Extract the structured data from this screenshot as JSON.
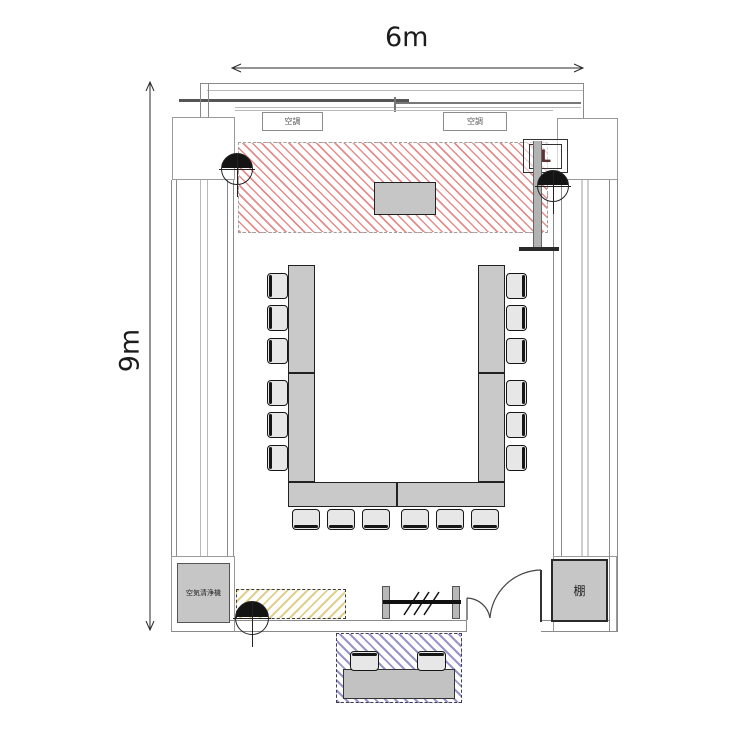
{
  "dimensions": {
    "width_label": "6m",
    "height_label": "9m"
  },
  "room": {
    "aircon_units": [
      {
        "label": "空調"
      },
      {
        "label": "空調"
      }
    ],
    "air_purifier_label": "空気清浄機",
    "shelf_label": "棚",
    "equipment_label": "L"
  },
  "zones": [
    {
      "name": "screen-projection-zone",
      "hatch": "red",
      "accent": "#d54646"
    },
    {
      "name": "floor-storage-zone",
      "hatch": "yellow",
      "accent": "#dbc776"
    },
    {
      "name": "waiting-bench-zone",
      "hatch": "blue",
      "accent": "#6868b4"
    }
  ],
  "colors": {
    "table_fill": "#c9c9c9",
    "wall_line": "#8a8a8a",
    "chair_fill": "#e7e7e7"
  },
  "furniture": {
    "tables": [
      {
        "x": 288,
        "y": 265,
        "w": 27,
        "h": 108
      },
      {
        "x": 288,
        "y": 373,
        "w": 27,
        "h": 109
      },
      {
        "x": 478,
        "y": 265,
        "w": 27,
        "h": 108
      },
      {
        "x": 478,
        "y": 373,
        "w": 27,
        "h": 109
      },
      {
        "x": 288,
        "y": 482,
        "w": 109,
        "h": 25
      },
      {
        "x": 397,
        "y": 482,
        "w": 108,
        "h": 25
      }
    ],
    "chairs": [
      {
        "x": 267,
        "y": 273,
        "w": 21,
        "h": 26,
        "dir": "w"
      },
      {
        "x": 267,
        "y": 305,
        "w": 21,
        "h": 26,
        "dir": "w"
      },
      {
        "x": 267,
        "y": 338,
        "w": 21,
        "h": 26,
        "dir": "w"
      },
      {
        "x": 267,
        "y": 380,
        "w": 21,
        "h": 26,
        "dir": "w"
      },
      {
        "x": 267,
        "y": 412,
        "w": 21,
        "h": 26,
        "dir": "w"
      },
      {
        "x": 267,
        "y": 445,
        "w": 21,
        "h": 26,
        "dir": "w"
      },
      {
        "x": 506,
        "y": 273,
        "w": 21,
        "h": 26,
        "dir": "e"
      },
      {
        "x": 506,
        "y": 305,
        "w": 21,
        "h": 26,
        "dir": "e"
      },
      {
        "x": 506,
        "y": 338,
        "w": 21,
        "h": 26,
        "dir": "e"
      },
      {
        "x": 506,
        "y": 380,
        "w": 21,
        "h": 26,
        "dir": "e"
      },
      {
        "x": 506,
        "y": 412,
        "w": 21,
        "h": 26,
        "dir": "e"
      },
      {
        "x": 506,
        "y": 445,
        "w": 21,
        "h": 26,
        "dir": "e"
      },
      {
        "x": 292,
        "y": 509,
        "w": 28,
        "h": 21,
        "dir": "s"
      },
      {
        "x": 327,
        "y": 509,
        "w": 28,
        "h": 21,
        "dir": "s"
      },
      {
        "x": 362,
        "y": 509,
        "w": 28,
        "h": 21,
        "dir": "s"
      },
      {
        "x": 401,
        "y": 509,
        "w": 28,
        "h": 21,
        "dir": "s"
      },
      {
        "x": 436,
        "y": 509,
        "w": 28,
        "h": 21,
        "dir": "s"
      },
      {
        "x": 471,
        "y": 509,
        "w": 28,
        "h": 21,
        "dir": "s"
      },
      {
        "x": 350,
        "y": 651,
        "w": 29,
        "h": 20,
        "dir": "n"
      },
      {
        "x": 417,
        "y": 651,
        "w": 29,
        "h": 20,
        "dir": "n"
      }
    ]
  },
  "speakers": [
    {
      "x": 221,
      "y": 153,
      "size": 30
    },
    {
      "x": 537,
      "y": 170,
      "size": 30
    },
    {
      "x": 235,
      "y": 601,
      "size": 32
    }
  ]
}
